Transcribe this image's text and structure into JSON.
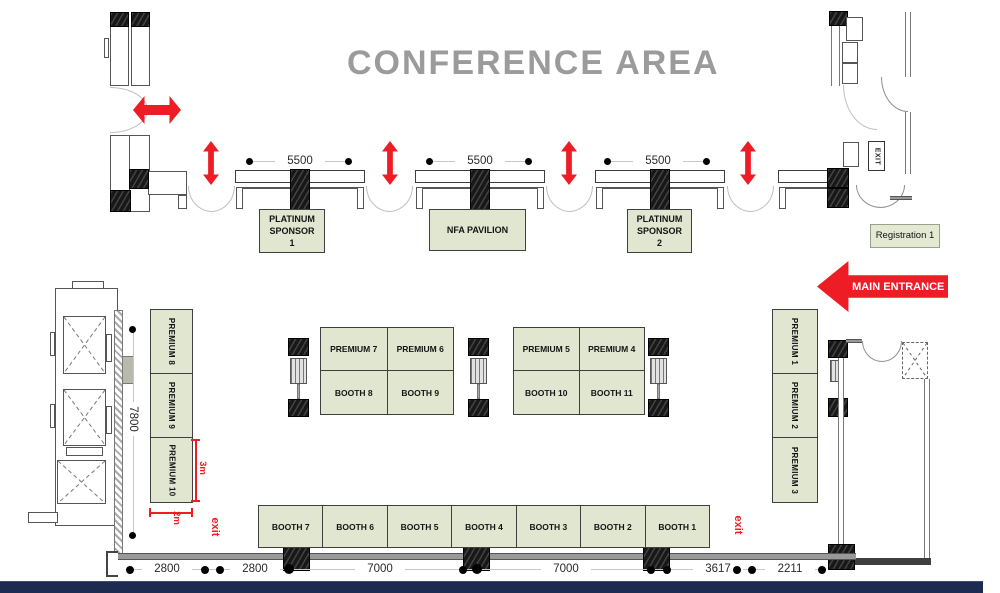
{
  "title": "CONFERENCE AREA",
  "signs": {
    "main_entrance": "MAIN ENTRANCE",
    "registration": "Registration 1",
    "exit_box": "EXIT",
    "exit_left": "exit",
    "exit_right": "exit"
  },
  "sponsors": {
    "platinum1": "PLATINUM\nSPONSOR\n1",
    "nfa": "NFA PAVILION",
    "platinum2": "PLATINUM\nSPONSOR\n2"
  },
  "booths": {
    "premium_left": [
      "PREMIUM 8",
      "PREMIUM 9",
      "PREMIUM 10"
    ],
    "premium_right": [
      "PREMIUM 1",
      "PREMIUM 2",
      "PREMIUM 3"
    ],
    "island_left": [
      "PREMIUM 7",
      "PREMIUM 6",
      "BOOTH 8",
      "BOOTH 9"
    ],
    "island_right": [
      "PREMIUM 5",
      "PREMIUM 4",
      "BOOTH 10",
      "BOOTH 11"
    ],
    "row": [
      "BOOTH 7",
      "BOOTH 6",
      "BOOTH 5",
      "BOOTH 4",
      "BOOTH 3",
      "BOOTH 2",
      "BOOTH 1"
    ]
  },
  "dimensions": {
    "tables": [
      "5500",
      "5500",
      "5500"
    ],
    "bottom": [
      "2800",
      "2800",
      "7000",
      "7000",
      "3617",
      "2211"
    ],
    "left_vertical": "7800",
    "booth_depth": "3m",
    "booth_width": "2m"
  },
  "colors": {
    "booth_green": "#e0e6d0",
    "accent_red": "#ee1c25",
    "footer_navy": "#1e2b50",
    "title_gray": "#9b9b9b"
  }
}
